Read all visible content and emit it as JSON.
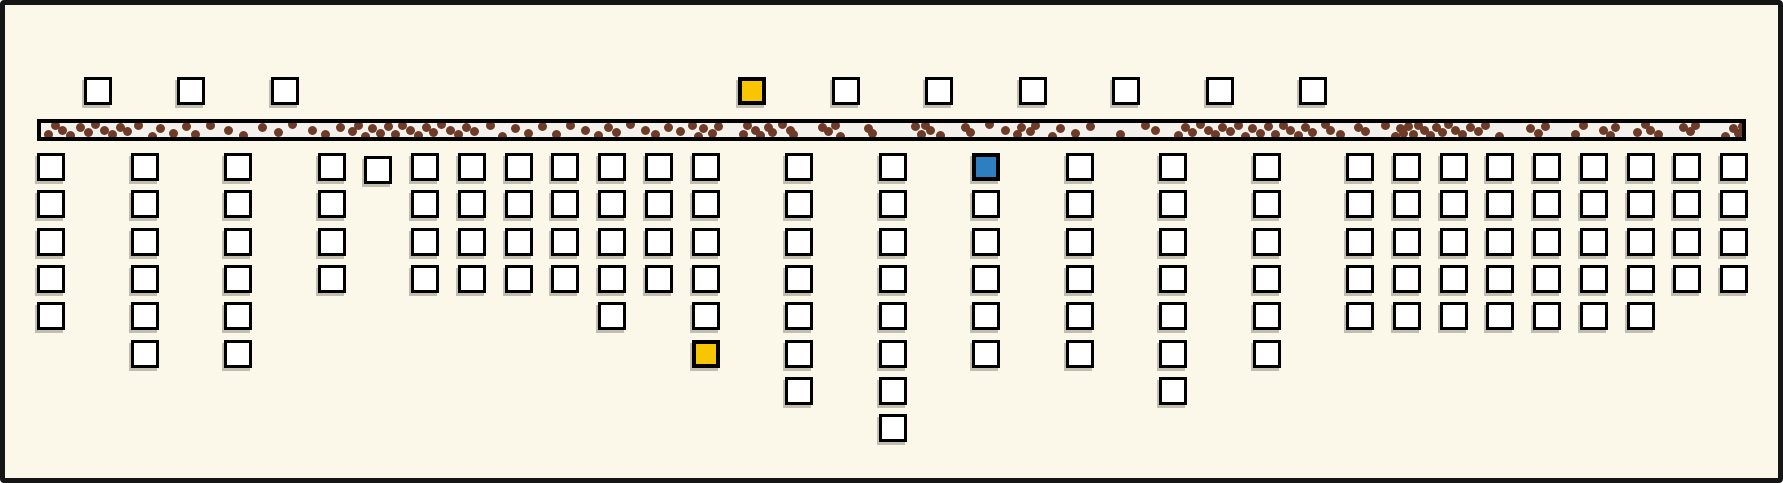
{
  "figure": {
    "width": 1783,
    "height": 483,
    "background": "#fbf8e9",
    "frame_color": "#151515",
    "frame_border_width": 5
  },
  "palette": {
    "square_fill": "#ffffff",
    "square_border": "#000000",
    "highlight_yellow": "#f7c600",
    "highlight_blue": "#2e7fc1",
    "dot_brown": "#6e3b28",
    "track_fill": "#f4f1ec"
  },
  "grid": {
    "first_center_x": 51,
    "col_pitch": 46.75,
    "square_size": 28,
    "top_row_center_y": 91,
    "row1_center_y": 167,
    "row_pitch": 37.33
  },
  "track": {
    "x": 37,
    "y": 119,
    "width": 1709,
    "height": 22,
    "border_width": 4,
    "dot_diameter": 9,
    "dots": [
      [
        48,
        0.85
      ],
      [
        55,
        0.15
      ],
      [
        62,
        0.55
      ],
      [
        70,
        0.95
      ],
      [
        80,
        0.3
      ],
      [
        88,
        0.7
      ],
      [
        95,
        0.05
      ],
      [
        104,
        0.5
      ],
      [
        112,
        0.9
      ],
      [
        120,
        0.25
      ],
      [
        127,
        0.6
      ],
      [
        138,
        0.1
      ],
      [
        152,
        1
      ],
      [
        160,
        0.4
      ],
      [
        173,
        0.75
      ],
      [
        186,
        0.2
      ],
      [
        195,
        0.85
      ],
      [
        210,
        0.15
      ],
      [
        228,
        0.55
      ],
      [
        243,
        0.95
      ],
      [
        262,
        0.3
      ],
      [
        278,
        0.7
      ],
      [
        292,
        0.05
      ],
      [
        312,
        0.5
      ],
      [
        325,
        0.9
      ],
      [
        340,
        0.25
      ],
      [
        352,
        0.6
      ],
      [
        358,
        0.1
      ],
      [
        365,
        1
      ],
      [
        372,
        0.4
      ],
      [
        380,
        0.75
      ],
      [
        388,
        0.2
      ],
      [
        395,
        0.85
      ],
      [
        402,
        0.15
      ],
      [
        410,
        0.55
      ],
      [
        418,
        0.95
      ],
      [
        426,
        0.3
      ],
      [
        433,
        0.7
      ],
      [
        441,
        0.05
      ],
      [
        450,
        0.5
      ],
      [
        458,
        0.9
      ],
      [
        466,
        0.25
      ],
      [
        474,
        0.6
      ],
      [
        490,
        0.1
      ],
      [
        502,
        1
      ],
      [
        515,
        0.4
      ],
      [
        528,
        0.75
      ],
      [
        542,
        0.2
      ],
      [
        556,
        0.85
      ],
      [
        570,
        0.15
      ],
      [
        585,
        0.55
      ],
      [
        598,
        0.95
      ],
      [
        608,
        0.3
      ],
      [
        616,
        0.7
      ],
      [
        630,
        0.05
      ],
      [
        645,
        0.5
      ],
      [
        655,
        0.9
      ],
      [
        668,
        0.25
      ],
      [
        680,
        0.6
      ],
      [
        692,
        0.1
      ],
      [
        698,
        1
      ],
      [
        703,
        0.4
      ],
      [
        712,
        0.75
      ],
      [
        718,
        0.2
      ],
      [
        743,
        0.85
      ],
      [
        747,
        0.15
      ],
      [
        755,
        0.55
      ],
      [
        760,
        0.95
      ],
      [
        768,
        0.3
      ],
      [
        772,
        0.7
      ],
      [
        782,
        0.05
      ],
      [
        790,
        0.5
      ],
      [
        793,
        0.9
      ],
      [
        822,
        0.25
      ],
      [
        828,
        0.6
      ],
      [
        835,
        0.1
      ],
      [
        840,
        1
      ],
      [
        868,
        0.4
      ],
      [
        872,
        0.75
      ],
      [
        915,
        0.2
      ],
      [
        921,
        0.85
      ],
      [
        925,
        0.15
      ],
      [
        930,
        0.55
      ],
      [
        940,
        0.95
      ],
      [
        965,
        0.3
      ],
      [
        970,
        0.7
      ],
      [
        989,
        0.05
      ],
      [
        1005,
        0.5
      ],
      [
        1017,
        0.9
      ],
      [
        1021,
        0.25
      ],
      [
        1030,
        0.6
      ],
      [
        1035,
        0.1
      ],
      [
        1052,
        1
      ],
      [
        1060,
        0.4
      ],
      [
        1075,
        0.75
      ],
      [
        1090,
        0.2
      ],
      [
        1120,
        0.85
      ],
      [
        1145,
        0.15
      ],
      [
        1155,
        0.55
      ],
      [
        1178,
        0.95
      ],
      [
        1185,
        0.3
      ],
      [
        1192,
        0.7
      ],
      [
        1200,
        0.05
      ],
      [
        1208,
        0.5
      ],
      [
        1215,
        0.9
      ],
      [
        1222,
        0.25
      ],
      [
        1230,
        0.6
      ],
      [
        1238,
        0.1
      ],
      [
        1245,
        1
      ],
      [
        1252,
        0.4
      ],
      [
        1260,
        0.75
      ],
      [
        1268,
        0.2
      ],
      [
        1275,
        0.85
      ],
      [
        1283,
        0.15
      ],
      [
        1290,
        0.55
      ],
      [
        1298,
        0.95
      ],
      [
        1305,
        0.3
      ],
      [
        1312,
        0.7
      ],
      [
        1325,
        0.05
      ],
      [
        1330,
        0.5
      ],
      [
        1340,
        0.9
      ],
      [
        1358,
        0.25
      ],
      [
        1365,
        0.6
      ],
      [
        1385,
        0.1
      ],
      [
        1395,
        1
      ],
      [
        1400,
        0.4
      ],
      [
        1403,
        0.75
      ],
      [
        1408,
        0.2
      ],
      [
        1413,
        0.85
      ],
      [
        1418,
        0.15
      ],
      [
        1424,
        0.55
      ],
      [
        1430,
        0.95
      ],
      [
        1436,
        0.3
      ],
      [
        1442,
        0.7
      ],
      [
        1448,
        0.05
      ],
      [
        1455,
        0.5
      ],
      [
        1462,
        0.9
      ],
      [
        1470,
        0.25
      ],
      [
        1478,
        0.6
      ],
      [
        1485,
        0.1
      ],
      [
        1499,
        1
      ],
      [
        1530,
        0.4
      ],
      [
        1538,
        0.75
      ],
      [
        1545,
        0.2
      ],
      [
        1575,
        0.85
      ],
      [
        1583,
        0.15
      ],
      [
        1603,
        0.55
      ],
      [
        1610,
        0.95
      ],
      [
        1615,
        0.3
      ],
      [
        1637,
        0.7
      ],
      [
        1645,
        0.05
      ],
      [
        1650,
        0.5
      ],
      [
        1658,
        0.9
      ],
      [
        1683,
        0.25
      ],
      [
        1690,
        0.6
      ],
      [
        1695,
        0.1
      ],
      [
        1725,
        1
      ],
      [
        1733,
        0.4
      ],
      [
        1738,
        0.75
      ],
      [
        1742,
        0.2
      ]
    ]
  },
  "top_row": [
    {
      "slot": 1,
      "color": "w"
    },
    {
      "slot": 3,
      "color": "w"
    },
    {
      "slot": 5,
      "color": "w"
    },
    {
      "slot": 15,
      "color": "y"
    },
    {
      "slot": 17,
      "color": "w"
    },
    {
      "slot": 19,
      "color": "w"
    },
    {
      "slot": 21,
      "color": "w"
    },
    {
      "slot": 23,
      "color": "w"
    },
    {
      "slot": 25,
      "color": "w"
    },
    {
      "slot": 27,
      "color": "w"
    }
  ],
  "columns": [
    {
      "slot": 0,
      "cells": [
        "w",
        "w",
        "w",
        "w",
        "w"
      ]
    },
    {
      "slot": 2,
      "cells": [
        "w",
        "w",
        "w",
        "w",
        "w",
        "w"
      ]
    },
    {
      "slot": 4,
      "cells": [
        "w",
        "w",
        "w",
        "w",
        "w",
        "w"
      ]
    },
    {
      "slot": 6,
      "cells": [
        "w",
        "w",
        "w",
        "w"
      ]
    },
    {
      "slot": 7,
      "dy": 3,
      "cells": [
        "w"
      ]
    },
    {
      "slot": 8,
      "cells": [
        "w",
        "w",
        "w",
        "w"
      ]
    },
    {
      "slot": 9,
      "cells": [
        "w",
        "w",
        "w",
        "w"
      ]
    },
    {
      "slot": 10,
      "cells": [
        "w",
        "w",
        "w",
        "w"
      ]
    },
    {
      "slot": 11,
      "cells": [
        "w",
        "w",
        "w",
        "w"
      ]
    },
    {
      "slot": 12,
      "cells": [
        "w",
        "w",
        "w",
        "w",
        "w"
      ]
    },
    {
      "slot": 13,
      "cells": [
        "w",
        "w",
        "w",
        "w"
      ]
    },
    {
      "slot": 14,
      "cells": [
        "w",
        "w",
        "w",
        "w",
        "w",
        "y"
      ]
    },
    {
      "slot": 16,
      "cells": [
        "w",
        "w",
        "w",
        "w",
        "w",
        "w",
        "w"
      ]
    },
    {
      "slot": 18,
      "cells": [
        "w",
        "w",
        "w",
        "w",
        "w",
        "w",
        "w",
        "w"
      ]
    },
    {
      "slot": 20,
      "cells": [
        "b",
        "w",
        "w",
        "w",
        "w",
        "w"
      ]
    },
    {
      "slot": 22,
      "cells": [
        "w",
        "w",
        "w",
        "w",
        "w",
        "w"
      ]
    },
    {
      "slot": 24,
      "cells": [
        "w",
        "w",
        "w",
        "w",
        "w",
        "w",
        "w"
      ]
    },
    {
      "slot": 26,
      "cells": [
        "w",
        "w",
        "w",
        "w",
        "w",
        "w"
      ]
    },
    {
      "slot": 28,
      "cells": [
        "w",
        "w",
        "w",
        "w",
        "w"
      ]
    },
    {
      "slot": 29,
      "cells": [
        "w",
        "w",
        "w",
        "w",
        "w"
      ]
    },
    {
      "slot": 30,
      "cells": [
        "w",
        "w",
        "w",
        "w",
        "w"
      ]
    },
    {
      "slot": 31,
      "cells": [
        "w",
        "w",
        "w",
        "w",
        "w"
      ]
    },
    {
      "slot": 32,
      "cells": [
        "w",
        "w",
        "w",
        "w",
        "w"
      ]
    },
    {
      "slot": 33,
      "cells": [
        "w",
        "w",
        "w",
        "w",
        "w"
      ]
    },
    {
      "slot": 34,
      "cells": [
        "w",
        "w",
        "w",
        "w",
        "w"
      ]
    },
    {
      "slot": 35,
      "cells": [
        "w",
        "w",
        "w",
        "w"
      ]
    },
    {
      "slot": 36,
      "cells": [
        "w",
        "w",
        "w",
        "w"
      ]
    }
  ]
}
